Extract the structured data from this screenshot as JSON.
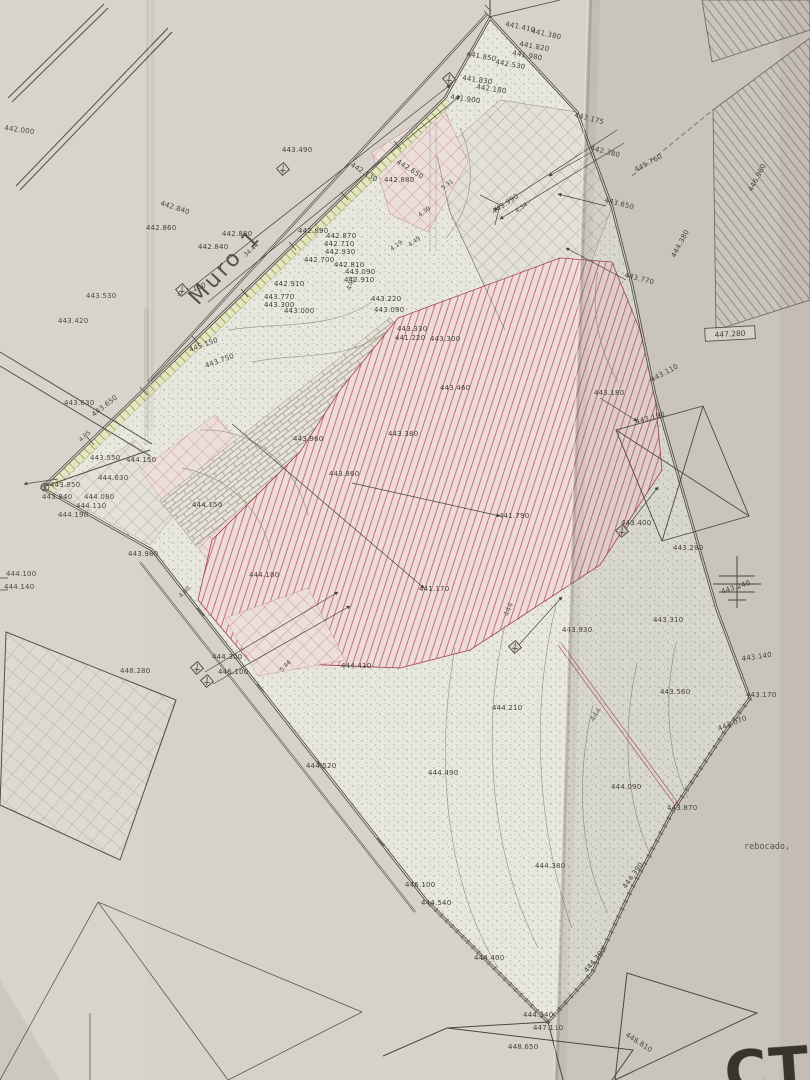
{
  "texts": {
    "muro_label": "Muro 1",
    "rebocado_label": "rebocado,",
    "cerca_label": "CTCA",
    "boxed_elevation": "447.280"
  },
  "colors": {
    "paper": "#d6d2ca",
    "ink": "#45413b",
    "red_hatch": "#c4737b",
    "green_strip": "#a3a959",
    "contour": "#8f8d7c"
  },
  "elevation_points": [
    {
      "v": "441.410",
      "x": 505,
      "y": 26,
      "r": 12
    },
    {
      "v": "441.380",
      "x": 531,
      "y": 33,
      "r": 12
    },
    {
      "v": "441.850",
      "x": 466,
      "y": 56,
      "r": 10
    },
    {
      "v": "441.820",
      "x": 519,
      "y": 46,
      "r": 10
    },
    {
      "v": "441.980",
      "x": 512,
      "y": 55,
      "r": 10
    },
    {
      "v": "442.530",
      "x": 495,
      "y": 64,
      "r": 10
    },
    {
      "v": "441.830",
      "x": 462,
      "y": 80,
      "r": 8
    },
    {
      "v": "442.180",
      "x": 476,
      "y": 89,
      "r": 8
    },
    {
      "v": "441.900",
      "x": 450,
      "y": 99,
      "r": 8
    },
    {
      "v": "442.175",
      "x": 574,
      "y": 117,
      "r": 14
    },
    {
      "v": "442.380",
      "x": 590,
      "y": 150,
      "r": 14
    },
    {
      "v": "443.650",
      "x": 604,
      "y": 202,
      "r": 14
    },
    {
      "v": "443.770",
      "x": 624,
      "y": 277,
      "r": 14
    },
    {
      "v": "442.000",
      "x": 4,
      "y": 130,
      "r": 8
    },
    {
      "v": "443.490",
      "x": 282,
      "y": 152,
      "r": 0
    },
    {
      "v": "442.130",
      "x": 350,
      "y": 166,
      "r": 32
    },
    {
      "v": "442.650",
      "x": 396,
      "y": 163,
      "r": 32
    },
    {
      "v": "442.880",
      "x": 384,
      "y": 182,
      "r": 0
    },
    {
      "v": "442.840",
      "x": 160,
      "y": 205,
      "r": 18
    },
    {
      "v": "442.860",
      "x": 146,
      "y": 230,
      "r": 0
    },
    {
      "v": "442.880",
      "x": 222,
      "y": 236,
      "r": 0
    },
    {
      "v": "442.840",
      "x": 198,
      "y": 249,
      "r": 0
    },
    {
      "v": "445.150",
      "x": 178,
      "y": 297,
      "r": -20
    },
    {
      "v": "443.530",
      "x": 86,
      "y": 298,
      "r": 0
    },
    {
      "v": "443.420",
      "x": 58,
      "y": 323,
      "r": 0
    },
    {
      "v": "445.150",
      "x": 190,
      "y": 352,
      "r": -20
    },
    {
      "v": "443.750",
      "x": 206,
      "y": 368,
      "r": -20
    },
    {
      "v": "443.630",
      "x": 64,
      "y": 405,
      "r": 0
    },
    {
      "v": "443.650",
      "x": 94,
      "y": 417,
      "r": -38
    },
    {
      "v": "442.890",
      "x": 298,
      "y": 233,
      "r": 0
    },
    {
      "v": "442.870",
      "x": 326,
      "y": 238,
      "r": 0
    },
    {
      "v": "442.710",
      "x": 324,
      "y": 246,
      "r": 0
    },
    {
      "v": "442.930",
      "x": 325,
      "y": 254,
      "r": 0
    },
    {
      "v": "442.700",
      "x": 304,
      "y": 262,
      "r": 0
    },
    {
      "v": "442.810",
      "x": 334,
      "y": 267,
      "r": 0
    },
    {
      "v": "443.090",
      "x": 345,
      "y": 274,
      "r": 0
    },
    {
      "v": "442.910",
      "x": 344,
      "y": 282,
      "r": 0
    },
    {
      "v": "442.910",
      "x": 274,
      "y": 286,
      "r": 0
    },
    {
      "v": "443.770",
      "x": 264,
      "y": 299,
      "r": 0
    },
    {
      "v": "443.300",
      "x": 264,
      "y": 307,
      "r": 0
    },
    {
      "v": "443.000",
      "x": 284,
      "y": 313,
      "r": 0
    },
    {
      "v": "443.220",
      "x": 371,
      "y": 301,
      "r": 0
    },
    {
      "v": "443.090",
      "x": 374,
      "y": 312,
      "r": 0
    },
    {
      "v": "443.330",
      "x": 397,
      "y": 331,
      "r": 0
    },
    {
      "v": "441.220",
      "x": 395,
      "y": 340,
      "r": 0
    },
    {
      "v": "443.300",
      "x": 430,
      "y": 341,
      "r": 0
    },
    {
      "v": "443.460",
      "x": 440,
      "y": 390,
      "r": 0
    },
    {
      "v": "443.380",
      "x": 388,
      "y": 436,
      "r": 0
    },
    {
      "v": "443.960",
      "x": 293,
      "y": 441,
      "r": 0
    },
    {
      "v": "443.860",
      "x": 329,
      "y": 476,
      "r": 0
    },
    {
      "v": "443.990",
      "x": 494,
      "y": 214,
      "r": -34
    },
    {
      "v": "443.550",
      "x": 90,
      "y": 460,
      "r": 0
    },
    {
      "v": "444.150",
      "x": 126,
      "y": 462,
      "r": 0
    },
    {
      "v": "444.630",
      "x": 98,
      "y": 480,
      "r": 0
    },
    {
      "v": "443.850",
      "x": 50,
      "y": 487,
      "r": 0
    },
    {
      "v": "443.840",
      "x": 42,
      "y": 499,
      "r": 0
    },
    {
      "v": "444.080",
      "x": 84,
      "y": 499,
      "r": 0
    },
    {
      "v": "444.110",
      "x": 76,
      "y": 508,
      "r": 0
    },
    {
      "v": "444.190",
      "x": 58,
      "y": 517,
      "r": 0
    },
    {
      "v": "444.150",
      "x": 192,
      "y": 507,
      "r": 0
    },
    {
      "v": "443.980",
      "x": 128,
      "y": 556,
      "r": 0
    },
    {
      "v": "444.100",
      "x": 6,
      "y": 576,
      "r": 0
    },
    {
      "v": "444.140",
      "x": 4,
      "y": 589,
      "r": 0
    },
    {
      "v": "448.280",
      "x": 120,
      "y": 673,
      "r": 0
    },
    {
      "v": "444.180",
      "x": 249,
      "y": 577,
      "r": 0
    },
    {
      "v": "441.790",
      "x": 499,
      "y": 518,
      "r": 0
    },
    {
      "v": "441.170",
      "x": 419,
      "y": 591,
      "r": 0
    },
    {
      "v": "444.300",
      "x": 212,
      "y": 659,
      "r": 0
    },
    {
      "v": "446.100",
      "x": 218,
      "y": 674,
      "r": 0
    },
    {
      "v": "444.410",
      "x": 341,
      "y": 668,
      "r": 0
    },
    {
      "v": "443.930",
      "x": 562,
      "y": 632,
      "r": 0
    },
    {
      "v": "444.210",
      "x": 492,
      "y": 710,
      "r": 0
    },
    {
      "v": "444.520",
      "x": 306,
      "y": 768,
      "r": 0
    },
    {
      "v": "444.490",
      "x": 428,
      "y": 775,
      "r": 0
    },
    {
      "v": "443.110",
      "x": 652,
      "y": 382,
      "r": -28
    },
    {
      "v": "443.180",
      "x": 594,
      "y": 395,
      "r": 0
    },
    {
      "v": "443.190",
      "x": 636,
      "y": 424,
      "r": -15
    },
    {
      "v": "443.400",
      "x": 621,
      "y": 525,
      "r": 0
    },
    {
      "v": "443.280",
      "x": 673,
      "y": 550,
      "r": 0
    },
    {
      "v": "443.240",
      "x": 722,
      "y": 594,
      "r": -18
    },
    {
      "v": "443.310",
      "x": 653,
      "y": 622,
      "r": 0
    },
    {
      "v": "443.140",
      "x": 742,
      "y": 661,
      "r": -8
    },
    {
      "v": "443.170",
      "x": 746,
      "y": 697,
      "r": 0
    },
    {
      "v": "443.070",
      "x": 719,
      "y": 731,
      "r": -22
    },
    {
      "v": "443.560",
      "x": 660,
      "y": 694,
      "r": 0
    },
    {
      "v": "444.090",
      "x": 611,
      "y": 789,
      "r": 0
    },
    {
      "v": "443.870",
      "x": 667,
      "y": 810,
      "r": 0
    },
    {
      "v": "445.760",
      "x": 636,
      "y": 172,
      "r": -28
    },
    {
      "v": "446.960",
      "x": 752,
      "y": 192,
      "r": -62
    },
    {
      "v": "444.380",
      "x": 675,
      "y": 258,
      "r": -62
    },
    {
      "v": "444.380",
      "x": 535,
      "y": 868,
      "r": 0
    },
    {
      "v": "444.390",
      "x": 626,
      "y": 889,
      "r": -55
    },
    {
      "v": "446.100",
      "x": 405,
      "y": 887,
      "r": 0
    },
    {
      "v": "444.540",
      "x": 421,
      "y": 905,
      "r": 0
    },
    {
      "v": "444.400",
      "x": 474,
      "y": 960,
      "r": 0
    },
    {
      "v": "444.390",
      "x": 587,
      "y": 973,
      "r": -50
    },
    {
      "v": "444.340",
      "x": 523,
      "y": 1017,
      "r": 0
    },
    {
      "v": "447.110",
      "x": 533,
      "y": 1030,
      "r": 0
    },
    {
      "v": "448.650",
      "x": 508,
      "y": 1049,
      "r": 0
    },
    {
      "v": "448.810",
      "x": 625,
      "y": 1036,
      "r": 33
    }
  ],
  "dimension_labels": [
    {
      "v": "34.44",
      "x": 246,
      "y": 257,
      "r": -42
    },
    {
      "v": "5.31",
      "x": 443,
      "y": 190,
      "r": -36
    },
    {
      "v": "4.39",
      "x": 420,
      "y": 217,
      "r": -36
    },
    {
      "v": "4.49",
      "x": 410,
      "y": 247,
      "r": -36
    },
    {
      "v": "4.19",
      "x": 392,
      "y": 251,
      "r": -36
    },
    {
      "v": "4.34",
      "x": 517,
      "y": 213,
      "r": -36
    },
    {
      "v": "4.85",
      "x": 81,
      "y": 442,
      "r": -42
    },
    {
      "v": "4.80",
      "x": 181,
      "y": 598,
      "r": -45
    },
    {
      "v": "5.44",
      "x": 282,
      "y": 672,
      "r": -45
    }
  ],
  "contour_labels": [
    {
      "v": "443",
      "x": 351,
      "y": 291,
      "r": -74
    },
    {
      "v": "444",
      "x": 508,
      "y": 617,
      "r": -68
    },
    {
      "v": "444",
      "x": 594,
      "y": 722,
      "r": -58
    }
  ],
  "symbols": [
    {
      "name": "survey-marker-top",
      "x": 449,
      "y": 79
    },
    {
      "name": "survey-marker-muro",
      "x": 283,
      "y": 169
    },
    {
      "name": "survey-marker-west",
      "x": 182,
      "y": 290
    },
    {
      "name": "survey-marker-sw-1",
      "x": 197,
      "y": 668
    },
    {
      "name": "survey-marker-sw-2",
      "x": 207,
      "y": 681
    },
    {
      "name": "survey-marker-south",
      "x": 515,
      "y": 647
    },
    {
      "name": "survey-marker-east",
      "x": 622,
      "y": 531
    }
  ]
}
